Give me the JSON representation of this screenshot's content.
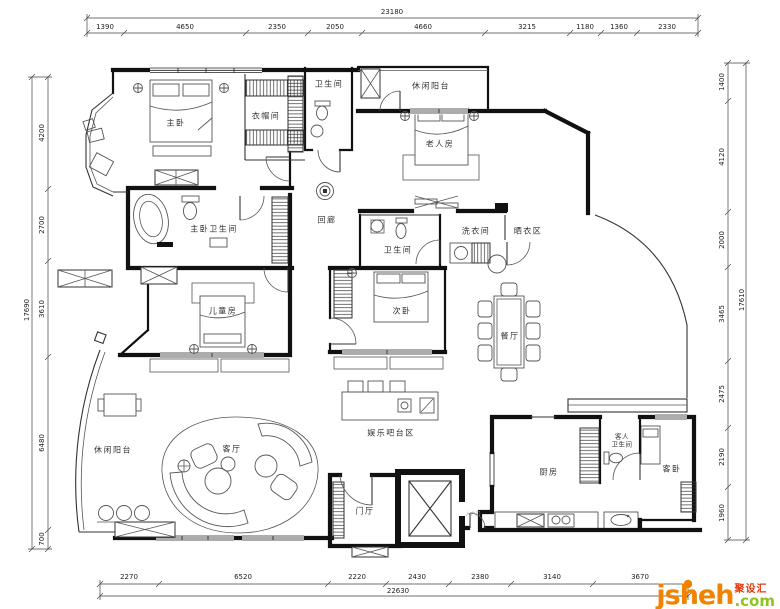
{
  "dims": {
    "top": {
      "overall": "23180",
      "segments": [
        "1390",
        "4650",
        "2350",
        "2050",
        "4660",
        "3215",
        "1180",
        "1360",
        "2330"
      ]
    },
    "left": {
      "overall": "17690",
      "segments": [
        "4200",
        "2700",
        "3610",
        "6480",
        "700"
      ]
    },
    "right": {
      "overall": "17610",
      "segments": [
        "1400",
        "4120",
        "2000",
        "3465",
        "2475",
        "2190",
        "1960"
      ]
    },
    "bottom": {
      "overall": "22630",
      "segments": [
        "2270",
        "6520",
        "2220",
        "2430",
        "2380",
        "3140",
        "3670"
      ]
    }
  },
  "rooms": [
    {
      "id": "master-bedroom",
      "label": "主卧"
    },
    {
      "id": "cloakroom",
      "label": "衣帽间"
    },
    {
      "id": "bathroom-top",
      "label": "卫生间"
    },
    {
      "id": "leisure-balcony-top",
      "label": "休闲阳台"
    },
    {
      "id": "elderly-room",
      "label": "老人房"
    },
    {
      "id": "master-bathroom",
      "label": "主卧卫生间"
    },
    {
      "id": "corridor",
      "label": "回廊"
    },
    {
      "id": "bathroom-middle",
      "label": "卫生间"
    },
    {
      "id": "laundry-room",
      "label": "洗衣间"
    },
    {
      "id": "drying-area",
      "label": "晒衣区"
    },
    {
      "id": "children-room",
      "label": "儿童房"
    },
    {
      "id": "second-bedroom",
      "label": "次卧"
    },
    {
      "id": "dining-room",
      "label": "餐厅"
    },
    {
      "id": "leisure-balcony-bottom",
      "label": "休闲阳台"
    },
    {
      "id": "living-room",
      "label": "客厅"
    },
    {
      "id": "bar-area",
      "label": "娱乐吧台区"
    },
    {
      "id": "foyer",
      "label": "门厅"
    },
    {
      "id": "kitchen",
      "label": "厨房"
    },
    {
      "id": "guest-bathroom",
      "line1": "客人",
      "line2": "卫生间"
    },
    {
      "id": "guest-bedroom",
      "label": "客卧"
    }
  ],
  "annotations": [
    {
      "id": "entry-door",
      "label": "入户门"
    }
  ],
  "logo": {
    "name": "jsheh",
    "tld": ".com",
    "cn": "聚设汇",
    "orange": "#F08300",
    "green": "#8FC31F",
    "red": "#E8380D"
  }
}
